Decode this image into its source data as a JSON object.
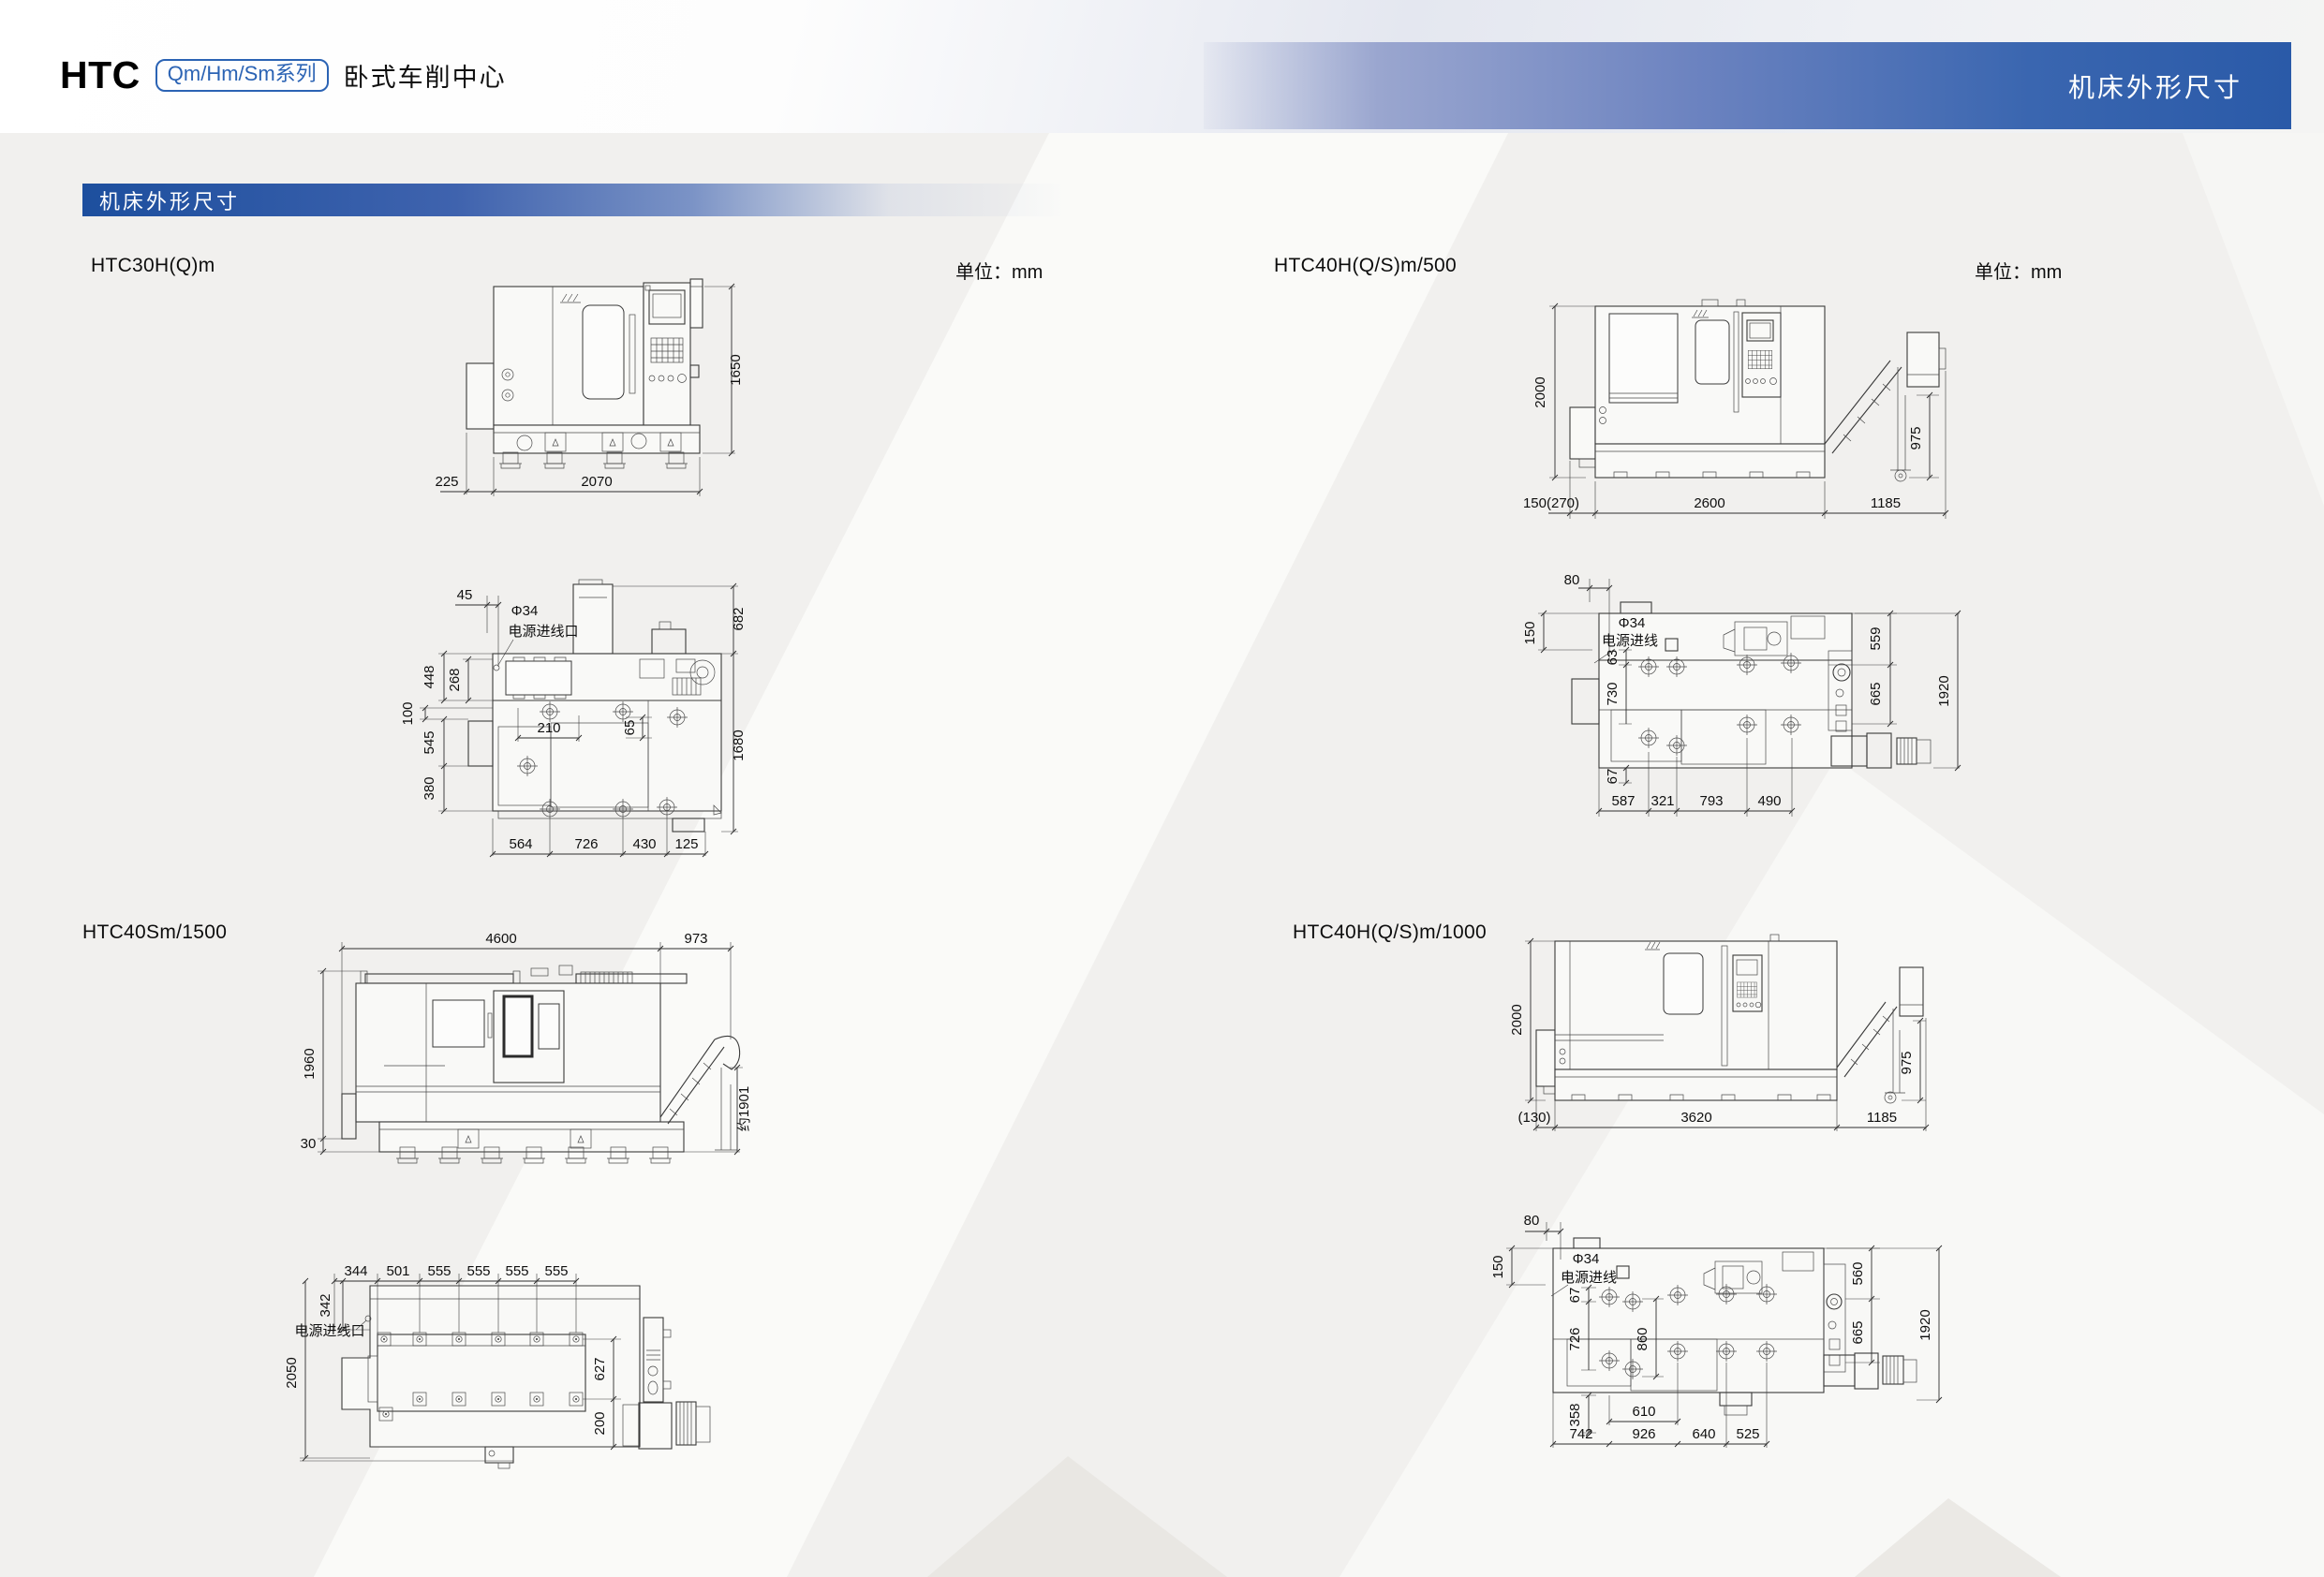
{
  "header": {
    "brand": "HTC",
    "series_badge": "Qm/Hm/Sm系列",
    "subtitle": "卧式车削中心",
    "banner_title": "机床外形尺寸"
  },
  "section_title": "机床外形尺寸",
  "unit_label": "单位：mm",
  "colors": {
    "banner_blue": "#2a5aa8",
    "section_blue": "#1d4f9e",
    "badge_blue": "#2b63b4",
    "page_bg": "#f1f0ee",
    "line_color": "#3a3a3a"
  },
  "drawings": {
    "htc30": {
      "title": "HTC30H(Q)m",
      "phi": "Φ34",
      "power_inlet": "电源进线口",
      "side": {
        "h1650": "1650",
        "w225": "225",
        "w2070": "2070"
      },
      "top": {
        "d45": "45",
        "d682": "682",
        "d448": "448",
        "d268": "268",
        "d100": "100",
        "d545": "545",
        "d380": "380",
        "d210": "210",
        "d65": "65",
        "d1680": "1680",
        "d564": "564",
        "d726": "726",
        "d430": "430",
        "d125": "125"
      }
    },
    "htc40_500": {
      "title": "HTC40H(Q/S)m/500",
      "phi": "Φ34",
      "power_inlet": "电源进线",
      "side": {
        "d2000": "2000",
        "d975": "975",
        "d150_270": "150(270)",
        "d2600": "2600",
        "d1185": "1185"
      },
      "top": {
        "d80": "80",
        "d150": "150",
        "d559": "559",
        "d665": "665",
        "d1920": "1920",
        "d63": "63",
        "d730": "730",
        "d67": "67",
        "d587": "587",
        "d321": "321",
        "d793": "793",
        "d490": "490"
      }
    },
    "htc40sm": {
      "title": "HTC40Sm/1500",
      "power_inlet": "电源进线口",
      "side": {
        "d4600": "4600",
        "d973": "973",
        "d1960": "1960",
        "d30": "30",
        "d1901": "约1901"
      },
      "top": {
        "d344": "344",
        "d501": "501",
        "d555": "555",
        "d342": "342",
        "d2050": "2050",
        "d627": "627",
        "d200": "200"
      }
    },
    "htc40_1000": {
      "title": "HTC40H(Q/S)m/1000",
      "phi": "Φ34",
      "power_inlet": "电源进线",
      "side": {
        "d2000": "2000",
        "d975": "975",
        "d130": "(130)",
        "d3620": "3620",
        "d1185": "1185"
      },
      "top": {
        "d80": "80",
        "d150": "150",
        "d560": "560",
        "d665": "665",
        "d1920": "1920",
        "d67": "67",
        "d726": "726",
        "d860": "860",
        "d358": "358",
        "d610": "610",
        "d742": "742",
        "d926": "926",
        "d640": "640",
        "d525": "525"
      }
    }
  }
}
